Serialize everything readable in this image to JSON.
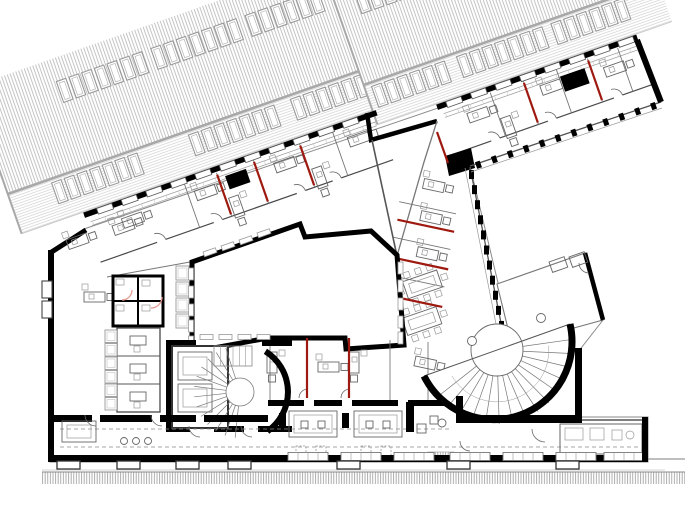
{
  "scene": {
    "width": 685,
    "height": 514,
    "background": "#ffffff",
    "description": "Black-and-white architectural floor plan of an office storey: diagonal street-front wing with neighbouring hatched roof and skylights above, office wings with red fire-partition lines around a white inner courtyard, a central winding stair with elevators, a large semicircular stair at the east end, and a street pavement hatch band at the bottom"
  },
  "palette": {
    "wall": "#000000",
    "wallSoft": "#2f2f2f",
    "line": "#666666",
    "thin": "#999999",
    "faint": "#c9c9c9",
    "hatch": "#b5b5b5",
    "longline": "#d2d2d2",
    "roofLine": "#a8a8a8",
    "red": "#9e1a10",
    "lightRed": "#e59a93",
    "dash": "#8a8a8a",
    "white": "#ffffff"
  },
  "roofFrames": [
    {
      "id": "roof-left",
      "tx": 84,
      "ty": 215,
      "rot": -19.3,
      "x0": -65,
      "len": 380,
      "hatchTop": -158,
      "hatchBot": -45,
      "longBot": -3,
      "skylights": {
        "w": 10,
        "h": 22,
        "pitch": 13.4,
        "rows": [
          {
            "v": -41,
            "runs": [
              [
                -20,
                7
              ],
              [
                125,
                7
              ],
              [
                233,
                7
              ]
            ]
          },
          {
            "v": -135,
            "runs": [
              [
                18,
                7
              ],
              [
                118,
                7
              ],
              [
                218,
                6
              ]
            ]
          }
        ]
      }
    },
    {
      "id": "roof-right",
      "tx": 437,
      "ty": 107,
      "rot": -19.3,
      "x0": -62,
      "len": 250,
      "hatchTop": -158,
      "hatchBot": -45,
      "longBot": -3,
      "skylights": {
        "w": 10,
        "h": 22,
        "pitch": 13.4,
        "rows": [
          {
            "v": -41,
            "runs": [
              [
                -55,
                6
              ],
              [
                35,
                7
              ],
              [
                135,
                6
              ]
            ]
          },
          {
            "v": -135,
            "runs": [
              [
                -40,
                5
              ]
            ]
          }
        ]
      }
    }
  ],
  "street": {
    "x": 42,
    "y": 472,
    "w": 643,
    "h": 12,
    "lineY": 470,
    "extraLine": [
      600,
      459,
      685,
      459
    ]
  },
  "wings": [
    {
      "id": "top-wing-west",
      "tx": 84,
      "ty": 215,
      "rot": -19.3,
      "len": 310,
      "windows": {
        "u0": 14,
        "pitch": 26,
        "w": 16,
        "h": 6
      },
      "partitions": [
        105,
        139,
        178,
        227,
        262
      ],
      "reds": [
        139,
        178,
        227
      ],
      "redSpan": [
        6,
        48
      ],
      "desks": [
        [
          34,
          16,
          0
        ],
        [
          112,
          14,
          0
        ],
        [
          152,
          32,
          90
        ],
        [
          196,
          14,
          0
        ],
        [
          240,
          32,
          90
        ],
        [
          274,
          14,
          0
        ]
      ],
      "shaft": [
        146,
        10,
        22,
        14
      ],
      "corridorY": 50,
      "doors": [
        60,
        120,
        208,
        246
      ]
    },
    {
      "id": "top-wing-east",
      "tx": 437,
      "ty": 107,
      "rot": -19.3,
      "len": 212,
      "windows": {
        "u0": 10,
        "pitch": 26,
        "w": 16,
        "h": 6
      },
      "partitions": [
        55,
        90,
        125,
        158,
        190
      ],
      "reds": [
        90,
        158
      ],
      "redSpan": [
        6,
        48
      ],
      "desks": [
        [
          26,
          16,
          0
        ],
        [
          66,
          32,
          90
        ],
        [
          104,
          14,
          0
        ],
        [
          170,
          18,
          0
        ]
      ],
      "shaft": [
        126,
        12,
        26,
        16
      ],
      "corridorY": 50,
      "doors": [
        40,
        100,
        170
      ]
    }
  ],
  "rightWing": {
    "tx": 424,
    "ty": 162,
    "rot": 12,
    "reds": [
      [
        -14,
        62,
        44,
        62
      ],
      [
        -10,
        100,
        46,
        100
      ],
      [
        -6,
        138,
        48,
        138
      ]
    ],
    "partitions": [
      [
        -14,
        80,
        44,
        80
      ],
      [
        -10,
        118,
        46,
        118
      ],
      [
        -16,
        44,
        42,
        44
      ]
    ],
    "desks": [
      [
        4,
        16,
        0
      ],
      [
        8,
        48,
        0
      ],
      [
        12,
        84,
        0
      ]
    ],
    "tables": [
      {
        "cx": 24,
        "cy": 120
      },
      {
        "cx": 31,
        "cy": 156
      }
    ],
    "facade": [
      470,
      167,
      503,
      333
    ],
    "facadeTicks": 11,
    "westWall": "M397,256 L424,162 L437,121"
  },
  "jog": {
    "wallPath": "M367,113 L371,140 L437,121",
    "thinWall": [
      372,
      140,
      397,
      256
    ],
    "cornerPoly": "445,156 471,148 475,168 449,176",
    "reds": [
      [
        437,
        132,
        448,
        163
      ]
    ]
  },
  "facadeSE": {
    "x1": 661,
    "y1": 102,
    "x2": 470,
    "y2": 166,
    "ticks": 12
  },
  "courtyard": {
    "points": "192,262 300,224 305,237 371,231 397,255 404,345 346,349 345,338 268,338 192,352",
    "winLeft": {
      "x": 188.5,
      "ys": [
        268,
        286,
        304,
        320,
        336
      ],
      "w": 5,
      "h": 12
    },
    "winRight": {
      "x": 398,
      "ys": [
        262,
        280,
        298,
        316,
        332
      ],
      "w": 5,
      "h": 12
    },
    "winBottom": {
      "y": 334.5,
      "xs": [
        200,
        219,
        238,
        257
      ],
      "w": 13,
      "h": 5
    },
    "winTop": [
      [
        203,
        252
      ],
      [
        221,
        246
      ],
      [
        239,
        240
      ],
      [
        257,
        233
      ]
    ]
  },
  "southOffices": {
    "rect": [
      268,
      338,
      190,
      66
    ],
    "reds": [
      [
        307,
        338,
        307,
        398
      ],
      [
        349,
        338,
        349,
        398
      ]
    ],
    "partitions": [
      [
        270,
        340,
        270,
        400
      ],
      [
        390,
        340,
        390,
        400
      ],
      [
        428,
        342,
        428,
        400
      ]
    ],
    "walls": [
      [
        268,
        400,
        36,
        6
      ],
      [
        314,
        400,
        28,
        6
      ],
      [
        352,
        400,
        46,
        6
      ],
      [
        408,
        400,
        44,
        6
      ]
    ],
    "desks": [
      [
        277,
        352,
        90
      ],
      [
        318,
        362,
        0
      ],
      [
        359,
        352,
        90
      ],
      [
        416,
        356,
        12
      ]
    ],
    "doorArcs": [
      [
        308,
        398,
        9
      ],
      [
        350,
        398,
        9
      ]
    ]
  },
  "leftWing": {
    "cornerDesks": [
      [
        66,
        240,
        -19.3
      ],
      [
        112,
        226,
        -19.3
      ],
      [
        84,
        292,
        0
      ]
    ],
    "wcBlock": {
      "x": 113,
      "y": 276,
      "w": 50,
      "h": 50,
      "divY": 301,
      "divX": 138
    },
    "wcArcs": [
      [
        122,
        290,
        10
      ],
      [
        151,
        297,
        11
      ]
    ],
    "roomCol": {
      "x": 117,
      "y": 328,
      "w": 43,
      "bottom": 412,
      "dividers": [
        356,
        384
      ]
    },
    "boxCol": {
      "x": 105,
      "ys": [
        330,
        343.5,
        357,
        370.5,
        384,
        397.5
      ],
      "w": 12,
      "h": 12.5
    },
    "corrBoxes": {
      "x": 176,
      "ys": [
        266,
        282,
        298,
        314
      ],
      "w": 13,
      "h": 14
    },
    "bays": [
      [
        42,
        281,
        10,
        17
      ],
      [
        42,
        301,
        10,
        17
      ]
    ],
    "colDesks": [
      [
        130,
        336
      ],
      [
        130,
        364
      ],
      [
        130,
        392
      ]
    ]
  },
  "coreStair": {
    "center": [
      240,
      392
    ],
    "rWall": 48,
    "wallArc": [
      -58,
      55
    ],
    "spokes": {
      "a0": 96,
      "a1": 252,
      "step": 13,
      "r0": 14,
      "r1": 46
    },
    "flight": {
      "x": 214,
      "y": 346,
      "w": 38,
      "h": 20,
      "n": 6
    },
    "landingR": 14,
    "elevator": {
      "x": 172,
      "y": 346,
      "w": 56,
      "h": 82,
      "cars": [
        [
          178,
          352,
          34,
          28
        ],
        [
          178,
          384,
          34,
          28
        ]
      ]
    },
    "walls": [
      [
        166,
        340,
        6,
        92
      ],
      [
        166,
        340,
        30,
        6
      ],
      [
        262,
        340,
        30,
        6
      ],
      [
        166,
        426,
        24,
        6
      ],
      [
        214,
        426,
        30,
        6
      ],
      [
        258,
        426,
        34,
        6
      ]
    ],
    "doorArcs": [
      [
        200,
        426,
        11
      ],
      [
        252,
        426,
        11
      ]
    ]
  },
  "grandStair": {
    "center": [
      497,
      350
    ],
    "r": 78,
    "diamA": [
      424,
      376
    ],
    "diamB": [
      570,
      324
    ],
    "spokes": {
      "a0": -8,
      "a1": 152,
      "step": 10.7,
      "r0": 26,
      "r1": 74
    },
    "innerR": 26,
    "guideR": 52,
    "knobs": [
      [
        472,
        341,
        4.5
      ],
      [
        541,
        318,
        4.5
      ]
    ],
    "frame": [
      [
        575,
        348,
        7,
        73
      ],
      [
        456,
        415,
        126,
        8
      ],
      [
        456,
        396,
        7,
        27
      ]
    ],
    "wedge": {
      "points": "497,284 585,253 603,320 512,345",
      "furniture": [
        [
          549,
          262
        ],
        [
          569,
          257
        ]
      ],
      "doorArc": [
        589,
        263,
        10
      ]
    }
  },
  "bottomWing": {
    "dashes": [
      [
        60,
        429,
        452,
        429
      ],
      [
        60,
        447,
        640,
        447
      ]
    ],
    "walls": [
      [
        50,
        415,
        42,
        7
      ],
      [
        100,
        415,
        52,
        7
      ],
      [
        160,
        415,
        36,
        7
      ],
      [
        204,
        415,
        64,
        7
      ]
    ],
    "stubs": [
      [
        279,
        413,
        7,
        15
      ],
      [
        342,
        413,
        7,
        15
      ],
      [
        406,
        402,
        8,
        30
      ]
    ],
    "tables": [
      [
        289,
        411
      ],
      [
        354,
        411
      ]
    ],
    "chairSquares": [
      [
        296,
        446
      ],
      [
        316,
        446
      ],
      [
        361,
        446
      ],
      [
        381,
        446
      ]
    ],
    "leftTable": [
      62,
      421,
      34,
      21
    ],
    "circles": [
      [
        124,
        441
      ],
      [
        136,
        441
      ],
      [
        148,
        441
      ]
    ],
    "smallSquares": [
      [
        417,
        424,
        9
      ],
      [
        430,
        416,
        8
      ]
    ],
    "smallCircle": [
      442,
      423,
      4
    ],
    "hatchBench": [
      428,
      452,
      26,
      8
    ],
    "rightRoom": {
      "x": 560,
      "y": 424,
      "w": 82,
      "h": 30,
      "rects": [
        [
          565,
          428,
          18,
          12
        ],
        [
          590,
          428,
          14,
          12
        ],
        [
          612,
          430,
          10,
          10
        ]
      ],
      "circle": [
        630,
        435,
        4
      ]
    },
    "doorArcs": [
      [
        96,
        415,
        11
      ],
      [
        162,
        415,
        11
      ],
      [
        545,
        429,
        13
      ],
      [
        470,
        441,
        10
      ]
    ],
    "bays": {
      "y": 461,
      "w": 23,
      "h": 8,
      "xs": [
        57,
        117,
        176,
        228,
        337,
        447,
        556
      ]
    },
    "winModules": {
      "y": 452.5,
      "w": 40,
      "h": 8,
      "xs": [
        288,
        341,
        394,
        450,
        503,
        556,
        604
      ]
    }
  }
}
